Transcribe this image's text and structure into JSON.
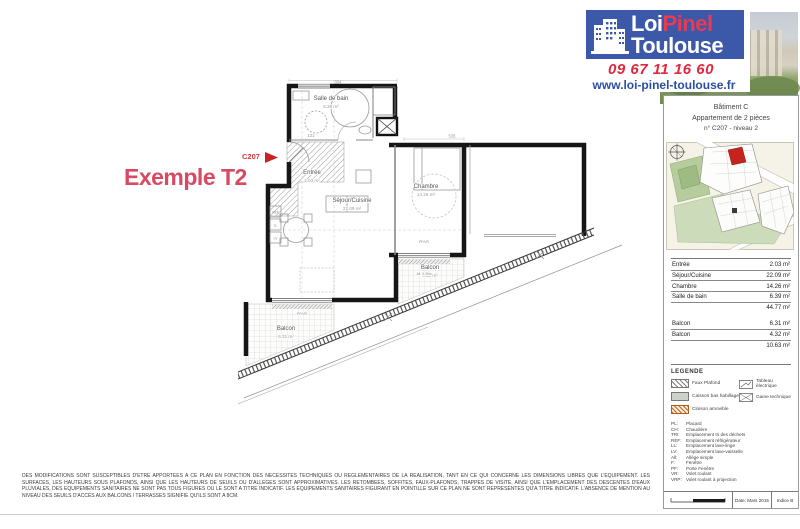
{
  "header": {
    "logo": {
      "word1_white": "Loi",
      "word1_red": "Pinel",
      "word2": "Toulouse",
      "phone": "09 67 11 16 60",
      "website": "www.loi-pinel-toulouse.fr"
    },
    "colors": {
      "logo_bg": "#3c58a8",
      "accent_red": "#e02840",
      "link_blue": "#2b4ea3",
      "title_pink": "#d84a63"
    }
  },
  "plan": {
    "example_label": "Exemple T2",
    "unit_tag": "C207",
    "rooms": {
      "salle_de_bain": {
        "name": "Salle de bain",
        "area": "6.39 m²"
      },
      "entree": {
        "name": "Entrée",
        "area": "2.03 m²"
      },
      "sejour": {
        "name": "Séjour/Cuisine",
        "area": "22.09 m²"
      },
      "chambre": {
        "name": "Chambre",
        "area": "14.26 m²"
      },
      "balcon_sejour": {
        "name": "Balcon",
        "area": "6.31 m²"
      },
      "balcon_chambre": {
        "name": "Balcon",
        "area": "4.32 m²"
      }
    },
    "dims": {
      "d1": "354",
      "d2": "535",
      "d3": "121"
    },
    "window_note": {
      "l1": "PF/VR",
      "l2": "All. 0.35m"
    },
    "kitchen": {
      "k1": "REF",
      "k2": "LL",
      "k3": "LV"
    }
  },
  "sidebar": {
    "title1": "Bâtiment C",
    "title2": "Appartement de 2 pièces",
    "title3": "n° C207 - niveau 2",
    "surfaces": {
      "rows": [
        {
          "label": "Entrée",
          "value": "2.03 m²"
        },
        {
          "label": "Séjour/Cuisine",
          "value": "22.09 m²"
        },
        {
          "label": "Chambre",
          "value": "14.26 m²"
        },
        {
          "label": "Salle de bain",
          "value": "6.39 m²"
        }
      ],
      "total": "44.77 m²",
      "balcony_rows": [
        {
          "label": "Balcon",
          "value": "6.31 m²"
        },
        {
          "label": "Balcon",
          "value": "4.32 m²"
        }
      ],
      "balcony_total": "10.63 m²"
    },
    "legend": {
      "title": "LEGENDE",
      "items_left": [
        {
          "label": "Faux Plafond"
        },
        {
          "label": "Caisson bas habillage"
        },
        {
          "label": "Cloison amovible"
        }
      ],
      "items_right": [
        {
          "label": "Tableau électrique"
        },
        {
          "label": "Gaine technique"
        }
      ],
      "abbreviations": [
        {
          "abbr": "PL:",
          "label": "Placard"
        },
        {
          "abbr": "CH:",
          "label": "Chaudière"
        },
        {
          "abbr": "TRI:",
          "label": "Emplacement tri des déchets"
        },
        {
          "abbr": "REF:",
          "label": "Emplacement réfrigérateur"
        },
        {
          "abbr": "LL:",
          "label": "Emplacement lave-linge"
        },
        {
          "abbr": "LV:",
          "label": "Emplacement lave-vaisselle"
        },
        {
          "abbr": "All:",
          "label": "Allège simple"
        },
        {
          "abbr": "F:",
          "label": "Fenêtre"
        },
        {
          "abbr": "PF:",
          "label": "Porte Fenêtre"
        },
        {
          "abbr": "VR:",
          "label": "Volet roulant"
        },
        {
          "abbr": "VRP:",
          "label": "Volet roulant à projection"
        }
      ]
    },
    "footer": {
      "date": "Date: Mars 2015",
      "index": "Indice B"
    }
  },
  "disclaimer": "DES MODIFICATIONS SONT SUSCEPTIBLES D'ETRE APPORTEES A CE PLAN EN FONCTION DES NECESSITES TECHNIQUES OU REGLEMENTAIRES DE LA REALISATION, TANT EN CE QUI CONCERNE LES DIMENSIONS LIBRES QUE L'EQUIPEMENT. LES SURFACES, LES HAUTEURS SOUS PLAFONDS, AINSI QUE LES HAUTEURS DE SEUILS OU D'ALLEGES SONT APPROXIMATIVES. LES RETOMBEES, SOFFITES, FAUX-PLAFONDS, TRAPPES DE VISITE, AINSI QUE L'EMPLACEMENT DES DESCENTES D'EAUX PLUVIALES, DES EQUIPEMENTS SANITAIRES NE SONT PAS TOUS FIGURES OU LE SONT A TITRE INDICATIF. LES EQUIPEMENTS SANITAIRES FIGURANT EN POINTILLE SUR CE PLAN NE SONT REPRESENTES QU'A TITRE INDICATIF. L'ABSENCE DE MENTION AU NIVEAU DES SEUILS D'ACCES AUX BALCONS / TERRASSES SIGNIFIE QU'ILS SONT A 8CM."
}
